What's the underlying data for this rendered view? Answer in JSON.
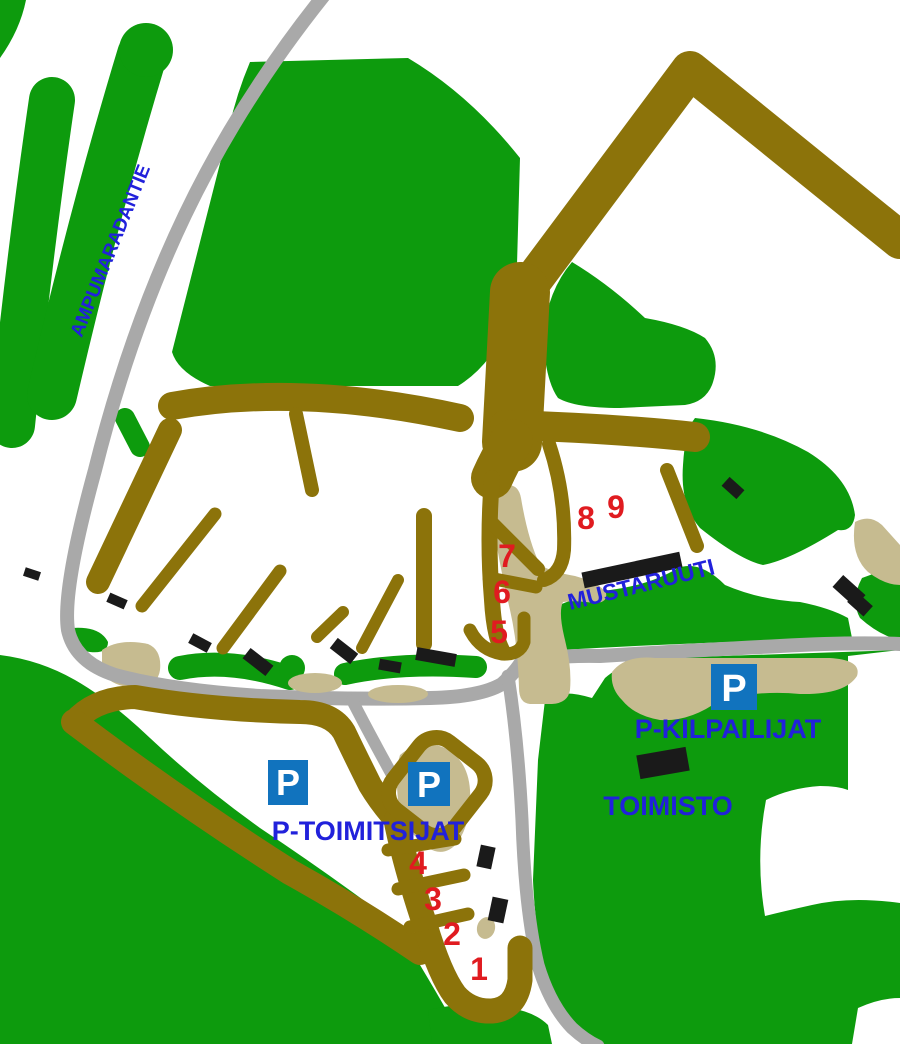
{
  "map": {
    "labels": {
      "road": "AMPUMARADANTIE",
      "range": "MUSTARUUTI",
      "parking_competitors": "P-KILPAILIJAT",
      "parking_officials": "P-TOIMITSIJAT",
      "office": "TOIMISTO"
    },
    "parking_symbol": "P",
    "lanes": [
      "1",
      "2",
      "3",
      "4",
      "5",
      "6",
      "7",
      "8",
      "9"
    ],
    "colors": {
      "forest": "#0D9B0D",
      "track": "#8C730A",
      "road": "#A9A9A9",
      "sand": "#C6BB90",
      "label": "#2121DB",
      "parking": "#1173BE",
      "number": "#E01B20",
      "building": "#1A1A1A"
    }
  }
}
